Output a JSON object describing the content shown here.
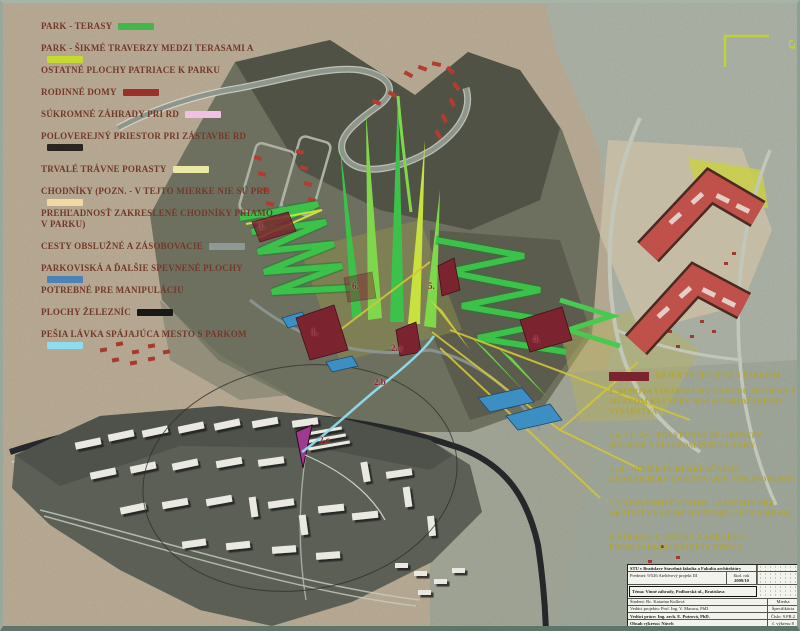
{
  "north": {
    "label": "S"
  },
  "legend": {
    "text_color": "#74382a",
    "items": [
      {
        "label": "PARK - TERASY",
        "color": "#45b649"
      },
      {
        "label": "PARK - ŠIKMÉ TRAVERZY MEDZI TERASAMI A",
        "label2": "OSTATNÉ PLOCHY PATRIACE K PARKU",
        "color": "#c6d92f"
      },
      {
        "label": "RODINNÉ DOMY",
        "color": "#9b2f29"
      },
      {
        "label": "SÚKROMNÉ ZÁHRADY PRI RD",
        "color": "#f2c0e4"
      },
      {
        "label": "POLOVEREJNÝ PRIESTOR PRI ZÁSTAVBE RD",
        "color": "#2b2420"
      },
      {
        "label": "TRVALÉ TRÁVNE PORASTY",
        "color": "#e9e9a5"
      },
      {
        "label": "CHODNÍKY (pozn. - v tejto mierke nie sú pre",
        "label2": "prehľadnosť zakreslené chodníky priamo v parku)",
        "color": "#f2d9a4"
      },
      {
        "label": "CESTY OBSLUŽNÉ A ZÁSOBOVACIE",
        "color": "#8d9897"
      },
      {
        "label": "PARKOVISKÁ A ĎALŠIE SPEVNENÉ PLOCHY",
        "label2": "POTREBNÉ PRE MANIPULÁCIU",
        "color": "#4b83b8"
      },
      {
        "label": "PLOCHY ŽELEZNÍC",
        "color": "#181818"
      },
      {
        "label": "PEŠIA LÁVKA SPÁJAJÚCA MESTO S PARKOM",
        "color": "#8fdcef"
      }
    ]
  },
  "annotations": {
    "heading": "OBJEKTY SPOJENÉ S PARKOM",
    "heading_swatch_color": "#7c2330",
    "items": [
      "1. BUDOVA VINÁRSKEHO ZÁVODU SPOJENÁ S MÚZEOM KULTÚRY MALOKARPATSKÉHO VINÁRSTVA",
      "2.a, 2.b, 2.c - POLYFUNKČNÉ OBJEKTY SPOJENÉ S TELESOM PEŠEJ LÁVKY",
      "3., 4. - OBJEKTY REKREAČNÉHO CHARAKTERU (UBYTOVANIE, STRAVOVANIE)",
      "5. VYBAVENOSŤ V LOME - ZÁZEMIE PRE AKTIVITY V LOME (LEZENIE, GEOCASHING)",
      "6. PIVNICA V AREÁLI ZÁHRADY S PREHLIADKOU DRUHOV VINIČA"
    ]
  },
  "map": {
    "markers": [
      {
        "label": "1."
      },
      {
        "label": "2.a"
      },
      {
        "label": "2.b"
      },
      {
        "label": "2.c"
      },
      {
        "label": "3."
      },
      {
        "label": "4."
      },
      {
        "label": "5."
      },
      {
        "label": "6."
      }
    ]
  },
  "titleblock": {
    "institution": "STU v Bratislave Stavebná fakulta a Fakulta architektúry",
    "subject": "Predmet: 9/526 Ateliérový projekt III",
    "year_label": "škol. rok",
    "year": "2009/10",
    "theme": "Téma: Vinné záhrady, Podhorská ul., Bratislava",
    "student": "Študent: Bc. Katarína Kullová",
    "supervisor": "Vedúci projektu: Prof. Ing. V. Macura, PhD.",
    "advisor": "Vedúci práce: Ing. arch. E. Putrová, PhD.",
    "number": "Číslo: 9.FR.2",
    "scale_label": "Mierka",
    "spec_label": "Špecifikácia",
    "content": "Obsah výkresu: Návrh",
    "sheet": "č. výkresu 8"
  }
}
